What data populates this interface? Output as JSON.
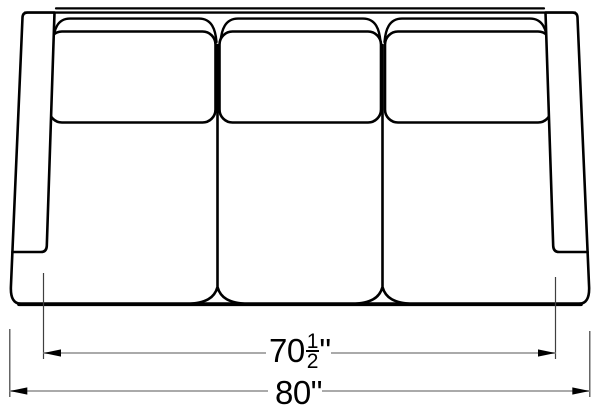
{
  "page": {
    "background": "#ffffff"
  },
  "drawing": {
    "subject": "three-seat sofa, front elevation line drawing",
    "outline_color": "#000000",
    "dimension_line_color": "#9e9e9e",
    "extension_line_color": "#3f3f3f",
    "arrowhead_color": "#000000",
    "dimensions": {
      "inner_width": {
        "whole": "70",
        "fraction_numerator": "1",
        "fraction_denominator": "2",
        "unit_mark": "\""
      },
      "overall_width": {
        "whole": "80",
        "unit_mark": "\""
      }
    }
  }
}
